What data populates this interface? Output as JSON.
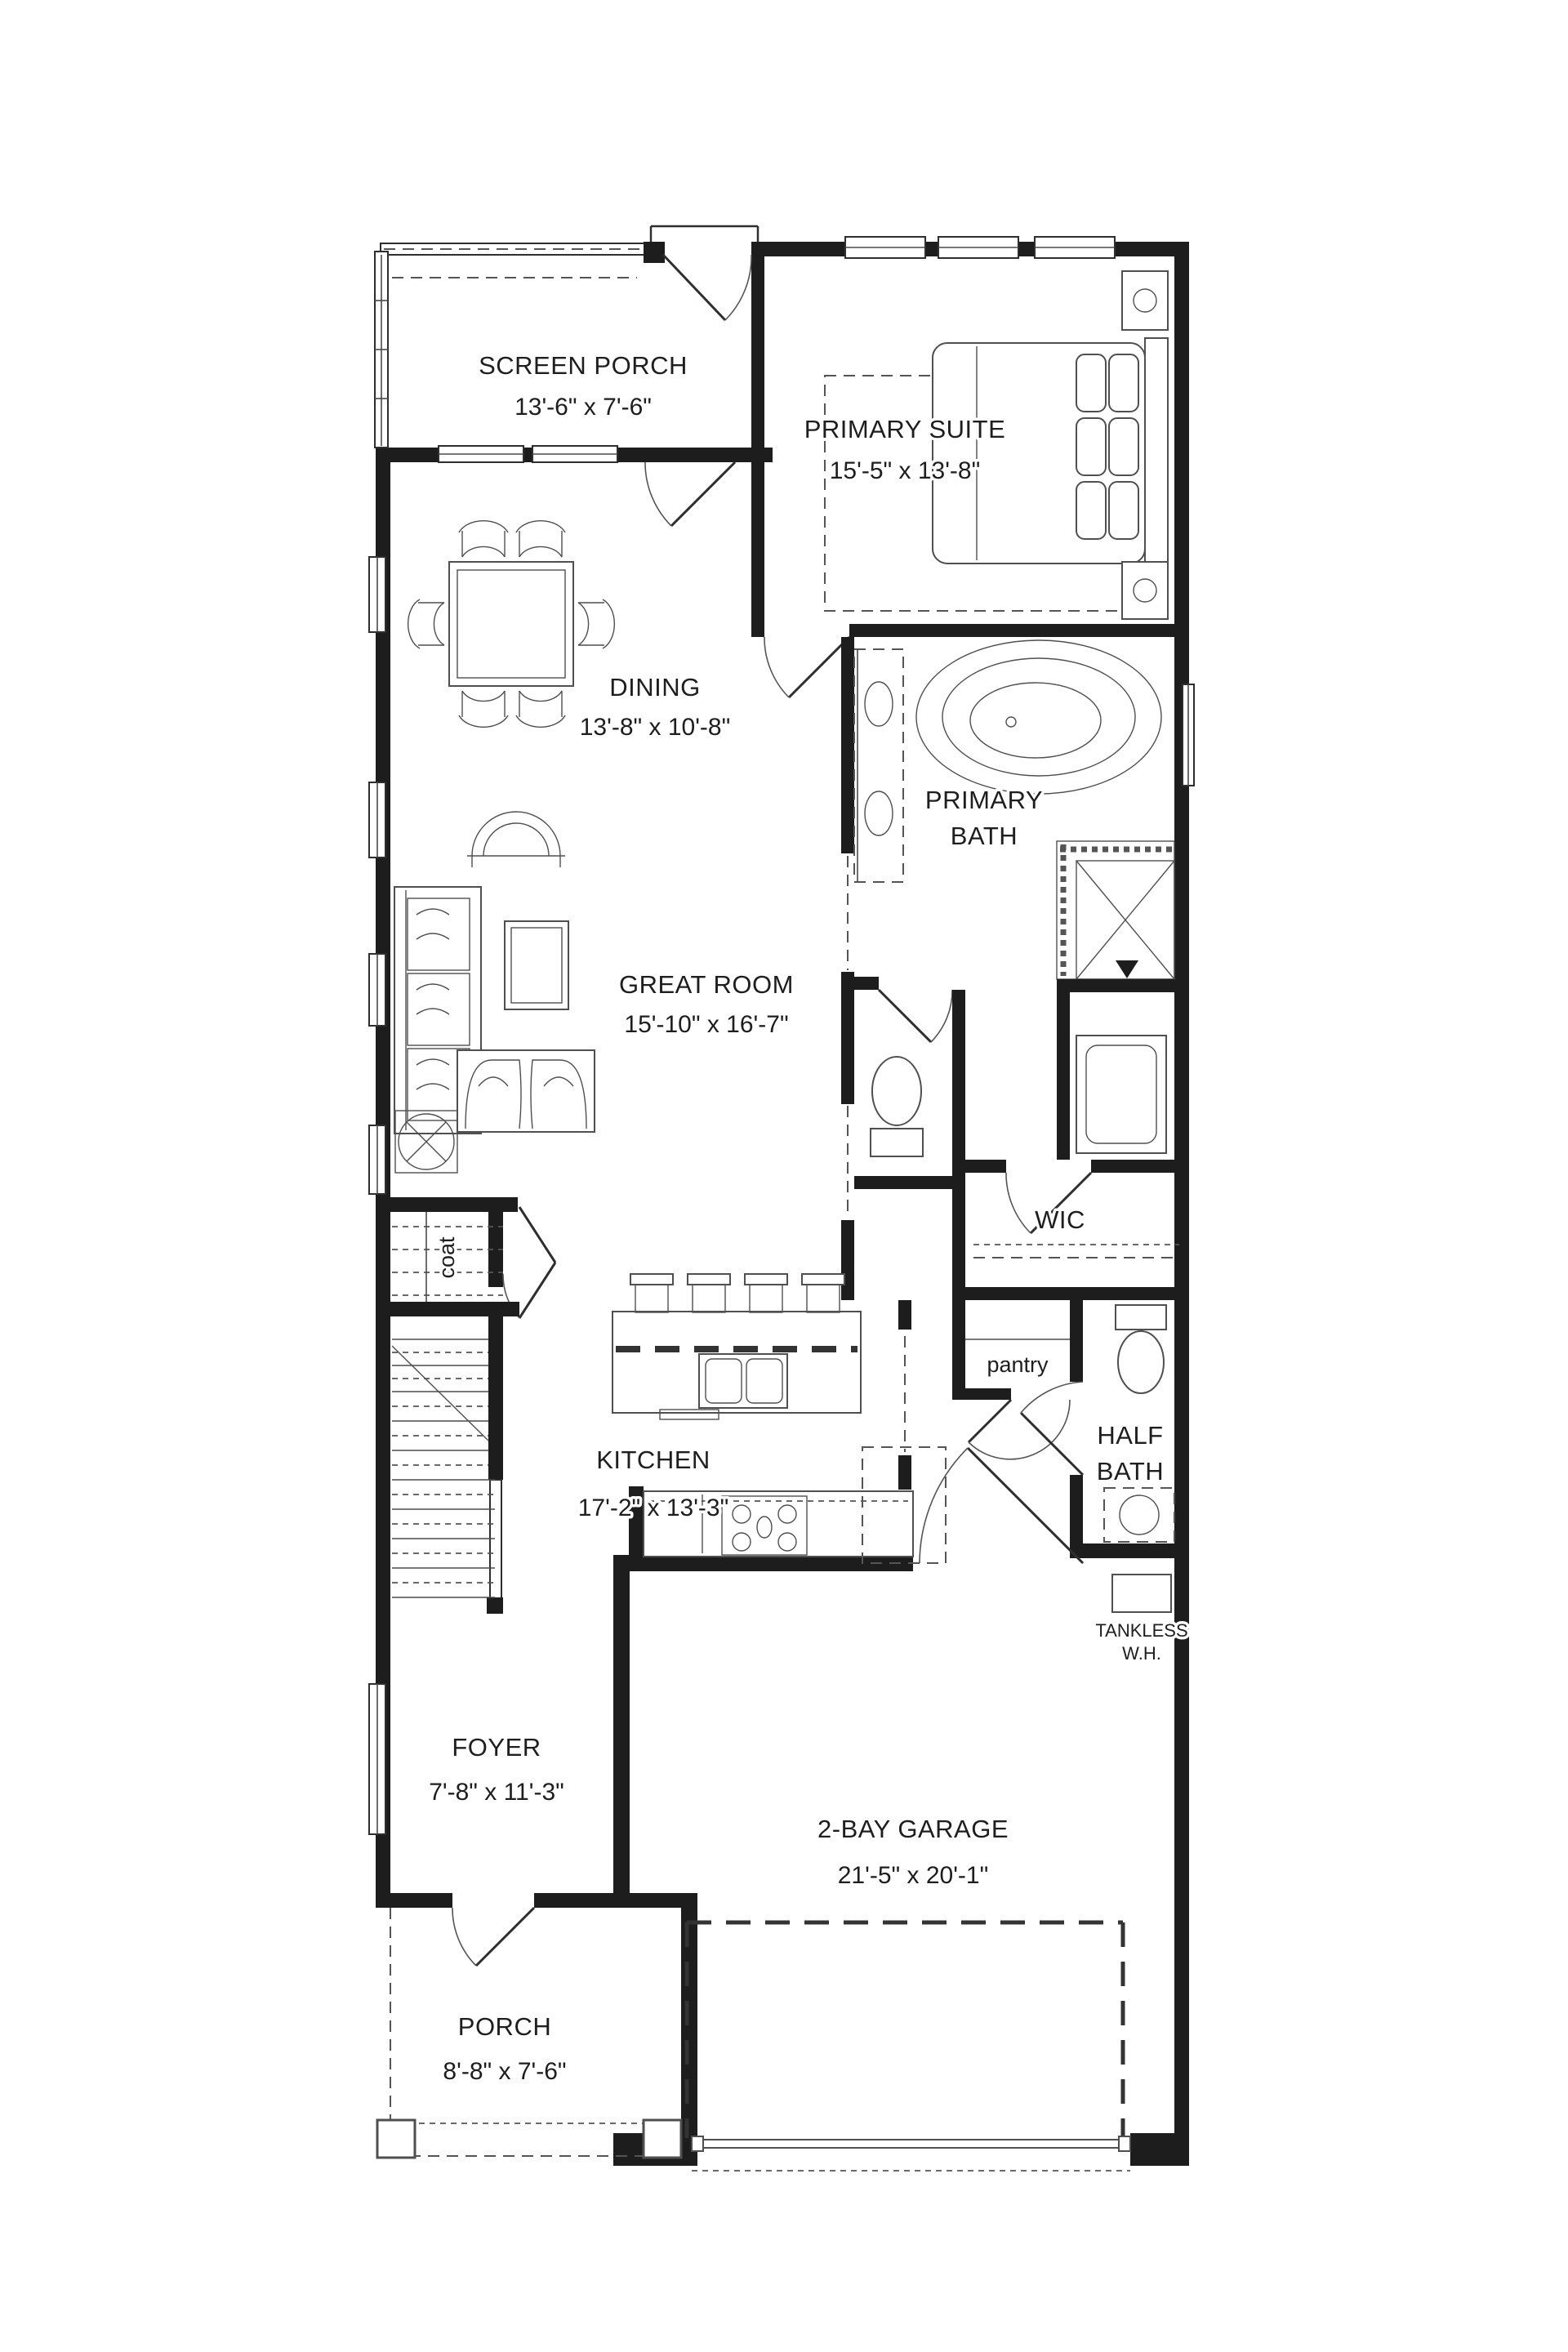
{
  "palette": {
    "wall": "#1d1d1d",
    "line": "#3c3c3c",
    "dash": "#555555",
    "text": "#1e1e1e",
    "background": "#ffffff"
  },
  "labels": {
    "screen_porch": {
      "name": "SCREEN PORCH",
      "dims": "13'-6\" x 7'-6\""
    },
    "primary_suite": {
      "name": "PRIMARY SUITE",
      "dims": "15'-5\" x 13'-8\""
    },
    "dining": {
      "name": "DINING",
      "dims": "13'-8\" x 10'-8\""
    },
    "primary_bath": {
      "line1": "PRIMARY",
      "line2": "BATH"
    },
    "great_room": {
      "name": "GREAT ROOM",
      "dims": "15'-10\" x 16'-7\""
    },
    "wic": {
      "name": "WIC"
    },
    "coat": {
      "name": "coat"
    },
    "pantry": {
      "name": "pantry"
    },
    "kitchen": {
      "name": "KITCHEN",
      "dims": "17'-2\" x 13'-3\""
    },
    "half_bath": {
      "line1": "HALF",
      "line2": "BATH"
    },
    "tankless_wh": {
      "line1": "TANKLESS",
      "line2": "W.H."
    },
    "foyer": {
      "name": "FOYER",
      "dims": "7'-8\" x 11'-3\""
    },
    "garage": {
      "name": "2-BAY GARAGE",
      "dims": "21'-5\" x 20'-1\""
    },
    "porch": {
      "name": "PORCH",
      "dims": "8'-8\" x 7'-6\""
    }
  }
}
